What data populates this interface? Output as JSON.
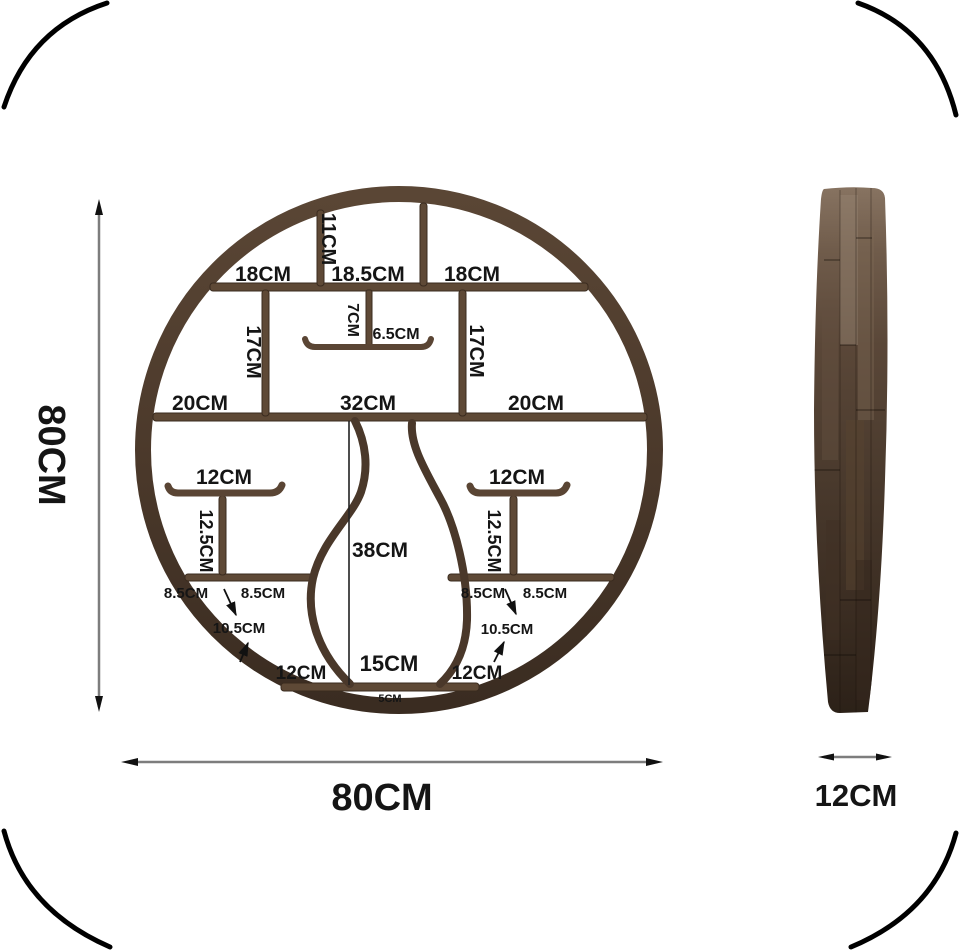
{
  "title": "Circular wall shelf dimension diagram",
  "dimensions": {
    "front_height": "80CM",
    "front_width": "80CM",
    "side_thickness": "12CM"
  },
  "front_labels": {
    "top_divider_height": "11CM",
    "top_row": [
      "18CM",
      "18.5CM",
      "18CM"
    ],
    "upper_left_divider": "17CM",
    "upper_right_divider": "17CM",
    "center_stub": "7CM",
    "center_mini_shelf": "6.5CM",
    "middle_row": [
      "20CM",
      "32CM",
      "20CM"
    ],
    "left_t_shelf": "12CM",
    "right_t_shelf": "12CM",
    "left_t_post": "12.5CM",
    "right_t_post": "12.5CM",
    "vase_height": "38CM",
    "left_lower_gaps": [
      "8.5CM",
      "8.5CM"
    ],
    "right_lower_gaps": [
      "8.5CM",
      "8.5CM"
    ],
    "left_diagonal": "10.5CM",
    "right_diagonal": "10.5CM",
    "bottom_row": [
      "12CM",
      "15CM",
      "12CM"
    ],
    "base_gap": "5CM"
  },
  "colors": {
    "wood_ring": "#4c3a2b",
    "wood_shelf": "#5e4936",
    "wood_dark": "#33271d",
    "dim_line": "#7d7d7d",
    "arrow": "#111111",
    "label_text": "#151515",
    "background": "#ffffff"
  }
}
